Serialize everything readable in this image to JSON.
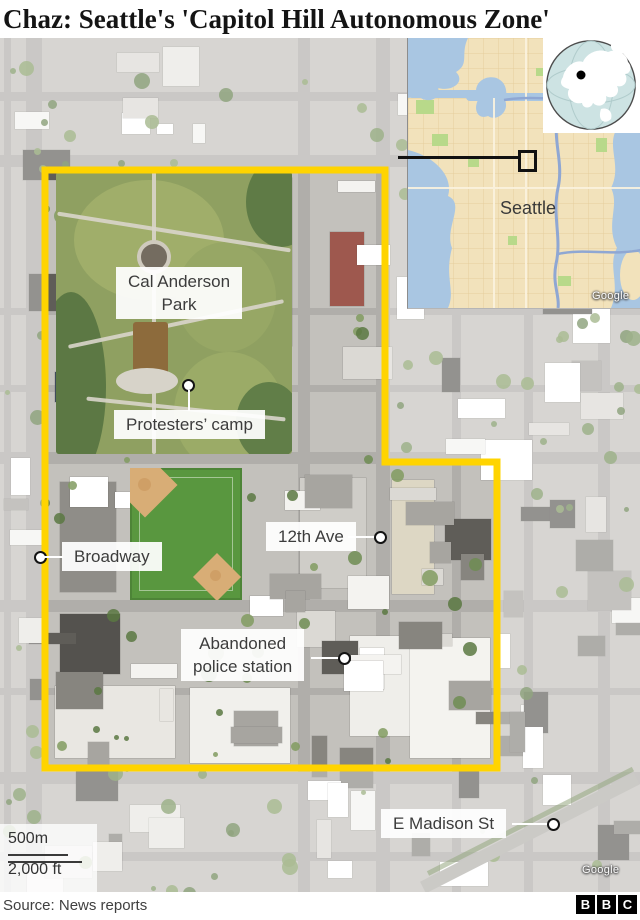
{
  "title": "Chaz: Seattle's 'Capitol Hill Autonomous Zone'",
  "map": {
    "boundary_color": "#ffd400",
    "labels": {
      "park": {
        "line1": "Cal Anderson",
        "line2": "Park"
      },
      "camp": {
        "text": "Protesters’ camp"
      },
      "broadway": {
        "text": "Broadway"
      },
      "ave12": {
        "text": "12th Ave"
      },
      "police": {
        "line1": "Abandoned",
        "line2": "police station"
      },
      "madison": {
        "text": "E Madison St"
      }
    },
    "scale": {
      "metric": "500m",
      "imperial": "2,000 ft"
    },
    "attribution": "Google"
  },
  "inset": {
    "city": "Seattle",
    "attribution": "Google"
  },
  "footer": {
    "source": "Source: News reports",
    "logo_letters": [
      "B",
      "B",
      "C"
    ]
  }
}
